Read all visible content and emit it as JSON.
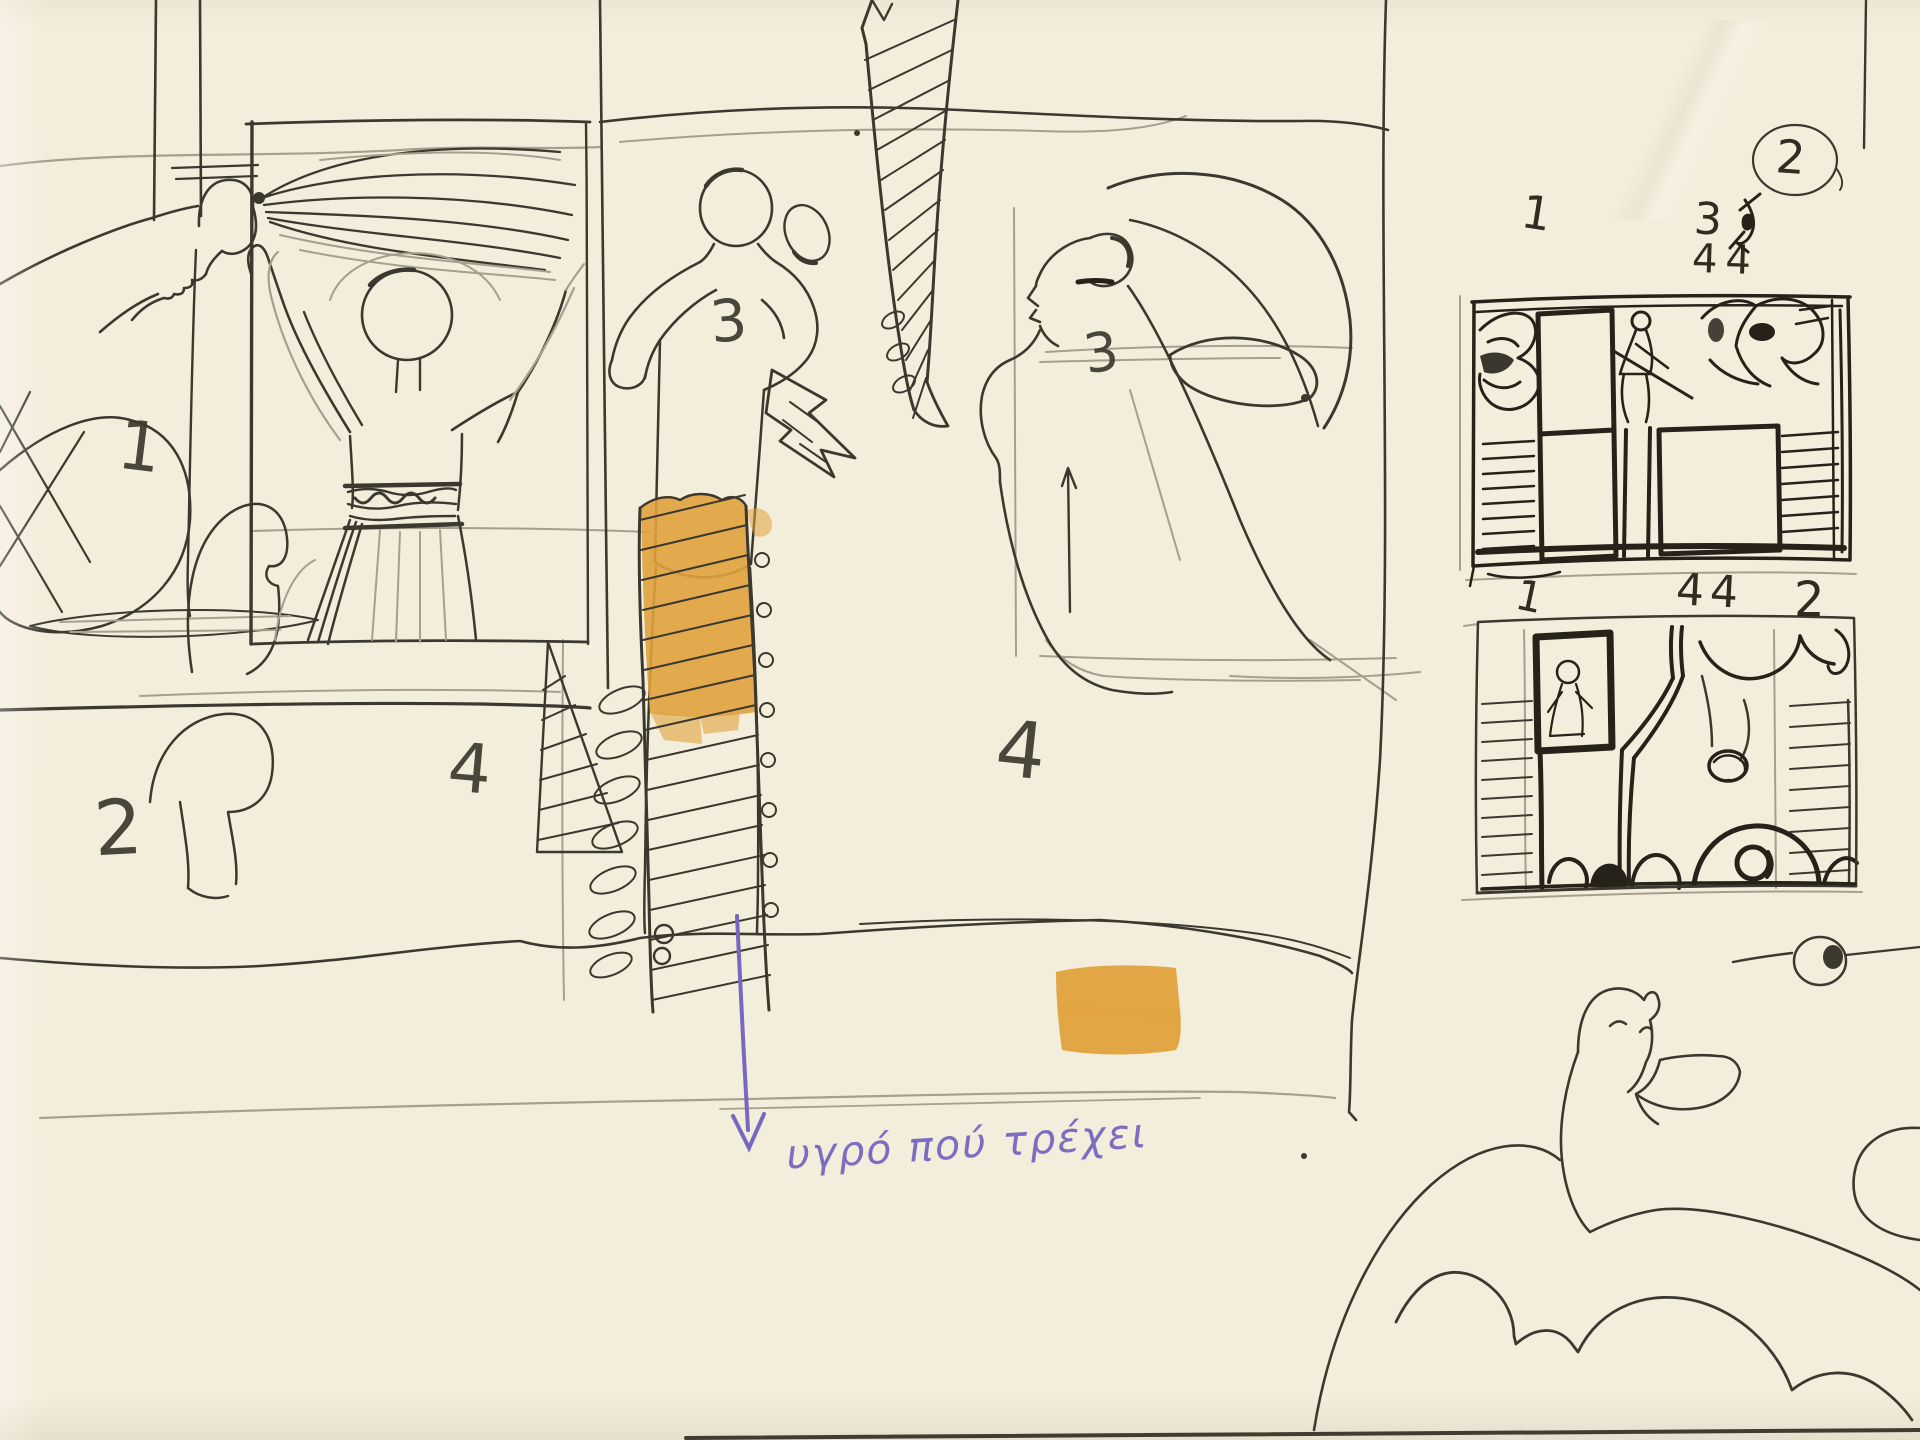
{
  "page": {
    "kind": "sketchbook page scan with storyboard studies",
    "paper_color": "#f3eddc",
    "ink_color": "#3b382f",
    "pencil_color": "#a69f8e",
    "heavy_ink_color": "#262219",
    "orange_color": "#e0a23c",
    "purple_color": "#7667c0"
  },
  "main_sketch": {
    "labels": {
      "scene1": "1",
      "scene2": "2",
      "scene3_center": "3",
      "scene3_right": "3",
      "scene4_left": "4",
      "scene4_right": "4"
    },
    "caption": "υγρό πού τρέχει"
  },
  "thumbnails": {
    "sheet_number_circled": "2",
    "top_strip": {
      "labels": {
        "pos1": "1",
        "pos3": "3",
        "pos44": "44"
      }
    },
    "bottom_strip": {
      "labels": {
        "pos1": "1",
        "pos44": "44",
        "pos2": "2"
      }
    }
  }
}
